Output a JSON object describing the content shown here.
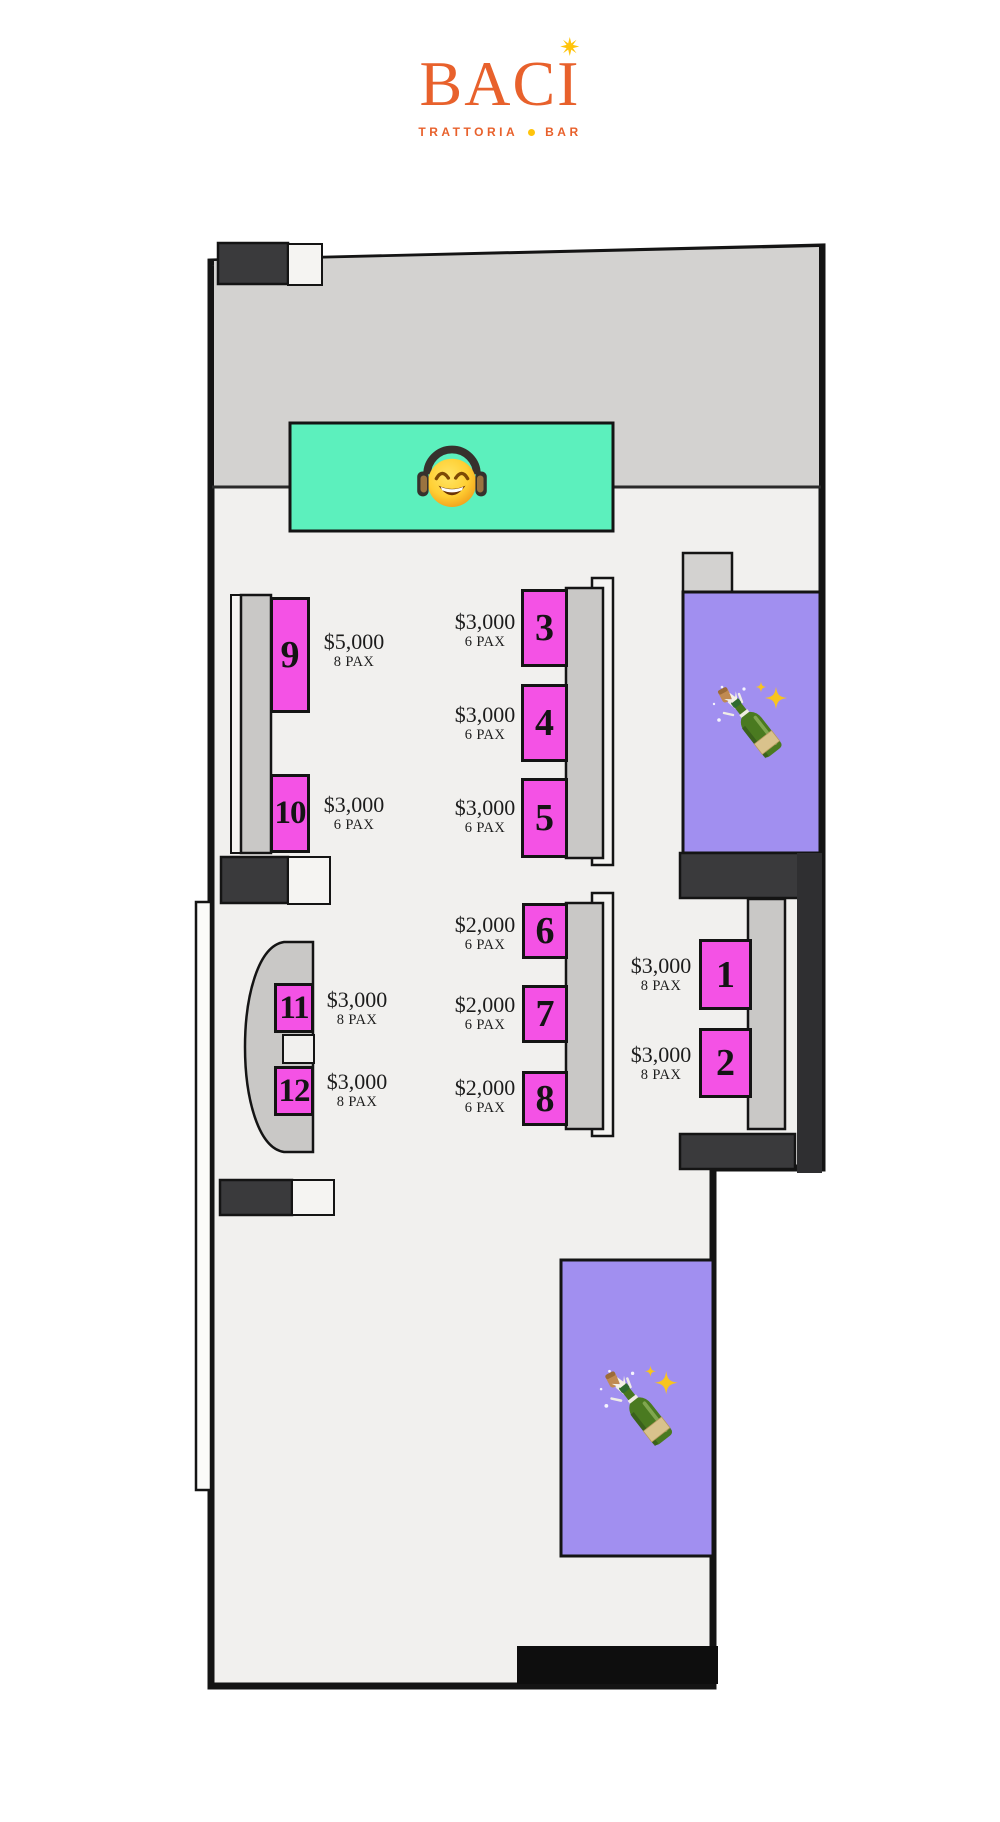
{
  "brand": {
    "name": "BACI",
    "name_prefix": "BAC",
    "name_i": "I",
    "tagline_word1": "TRATTORIA",
    "tagline_word2": "BAR"
  },
  "tables": {
    "t1": {
      "number": "1",
      "price": "$3,000",
      "pax": "8 PAX"
    },
    "t2": {
      "number": "2",
      "price": "$3,000",
      "pax": "8 PAX"
    },
    "t3": {
      "number": "3",
      "price": "$3,000",
      "pax": "6 PAX"
    },
    "t4": {
      "number": "4",
      "price": "$3,000",
      "pax": "6 PAX"
    },
    "t5": {
      "number": "5",
      "price": "$3,000",
      "pax": "6 PAX"
    },
    "t6": {
      "number": "6",
      "price": "$2,000",
      "pax": "6 PAX"
    },
    "t7": {
      "number": "7",
      "price": "$2,000",
      "pax": "6 PAX"
    },
    "t8": {
      "number": "8",
      "price": "$2,000",
      "pax": "6 PAX"
    },
    "t9": {
      "number": "9",
      "price": "$5,000",
      "pax": "8 PAX"
    },
    "t10": {
      "number": "10",
      "price": "$3,000",
      "pax": "6 PAX"
    },
    "t11": {
      "number": "11",
      "price": "$3,000",
      "pax": "8 PAX"
    },
    "t12": {
      "number": "12",
      "price": "$3,000",
      "pax": "8 PAX"
    }
  },
  "icons": {
    "logo_star": "sun-star-icon",
    "tagline_dot": "yellow-dot-icon",
    "dj_booth": "smiling-face-with-headphones-emoji",
    "dance_floor": "champagne-bottle-popping-cork-emoji",
    "sparkles": "sparkles-emoji"
  },
  "colors": {
    "brand-orange": "#e8612c",
    "logo-star-yellow": "#ffc40c",
    "table-pink": "#f452e5",
    "stage-green": "#5cf0bd",
    "dance-floor-purple": "#a18ff0",
    "floor-light": "#f1f0ee",
    "back-area-gray": "#d3d2d0",
    "bench-gray": "#c9c8c6",
    "wall-dark": "#3a3a3c",
    "text-black": "#141414"
  }
}
